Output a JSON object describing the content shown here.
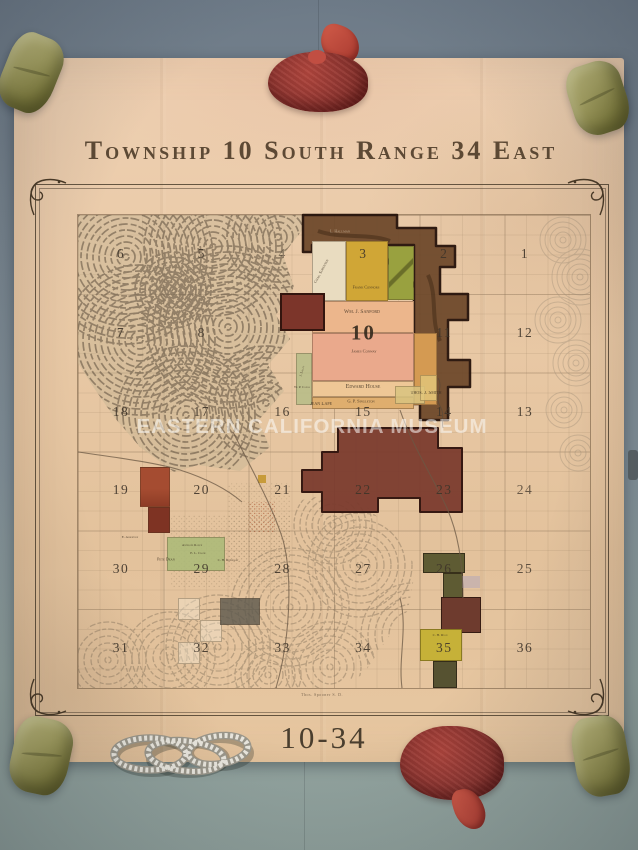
{
  "map": {
    "title": "Township 10 South Range 34 East",
    "sheet_label": "10-34",
    "watermark": "EASTERN CALIFORNIA MUSEUM",
    "credit_line": "Thos. Spooner S. D.",
    "grid": {
      "rows": [
        [
          "6",
          "5",
          "4",
          "3",
          "2",
          "1"
        ],
        [
          "7",
          "8",
          "9",
          "10",
          "11",
          "12"
        ],
        [
          "18",
          "17",
          "16",
          "15",
          "14",
          "13"
        ],
        [
          "19",
          "20",
          "21",
          "22",
          "23",
          "24"
        ],
        [
          "30",
          "29",
          "28",
          "27",
          "26",
          "25"
        ],
        [
          "31",
          "32",
          "33",
          "34",
          "35",
          "36"
        ]
      ],
      "big_number": "10",
      "muted": {
        "9": 0.15,
        "4": 0.55,
        "24": 0.75,
        "25": 0.8
      }
    },
    "parcel_labels": [
      {
        "text": "Chas. Sorensen",
        "x": 243,
        "y": 56,
        "size": 4,
        "rotate": -62
      },
      {
        "text": "Frank Connors",
        "x": 288,
        "y": 72,
        "size": 4
      },
      {
        "text": "L. Hallman",
        "x": 262,
        "y": 16,
        "size": 4,
        "light": true
      },
      {
        "text": "Wm. J. Sanford",
        "x": 284,
        "y": 97,
        "size": 5.5
      },
      {
        "text": "James Conway",
        "x": 286,
        "y": 136,
        "size": 4.5
      },
      {
        "text": "Edward House",
        "x": 285,
        "y": 172,
        "size": 6
      },
      {
        "text": "G. P. Singleton",
        "x": 283,
        "y": 186,
        "size": 4.5
      },
      {
        "text": "Thos. J. Smith",
        "x": 348,
        "y": 178,
        "size": 5
      },
      {
        "text": "Jean Lape",
        "x": 243,
        "y": 189,
        "size": 5
      },
      {
        "text": "W. P. Canal",
        "x": 224,
        "y": 172,
        "size": 3.5
      },
      {
        "text": "J. Lilley",
        "x": 224,
        "y": 156,
        "size": 3.5,
        "rotate": -75
      },
      {
        "text": "C. H. Ryan",
        "x": 362,
        "y": 420,
        "size": 3.5
      },
      {
        "text": "E. Albertson",
        "x": 52,
        "y": 322,
        "size": 3.5
      },
      {
        "text": "Antelope Ranch",
        "x": 114,
        "y": 330,
        "size": 3.5
      },
      {
        "text": "E. L. Crane",
        "x": 120,
        "y": 338,
        "size": 3.5
      },
      {
        "text": "Pete Dean",
        "x": 88,
        "y": 344,
        "size": 4
      },
      {
        "text": "C. H. Rhinehart",
        "x": 150,
        "y": 345,
        "size": 3.5
      }
    ]
  },
  "palette": {
    "canvas": "#e9c9a6",
    "ink": "#42382c",
    "brown_region": "#6e492b",
    "maroon_region": "#7b3b2e",
    "background_top": "#73808b",
    "background_bottom": "#95a6a0",
    "watermark_color": "rgba(252,252,249,0.55)"
  },
  "scene": {
    "props": [
      "sandbag-weight-top-left",
      "sandbag-weight-top-right",
      "sandbag-weight-bottom-left",
      "sandbag-weight-bottom-right",
      "red-mesh-bag-top",
      "red-mesh-bag-bottom",
      "white-rope-coil"
    ]
  }
}
